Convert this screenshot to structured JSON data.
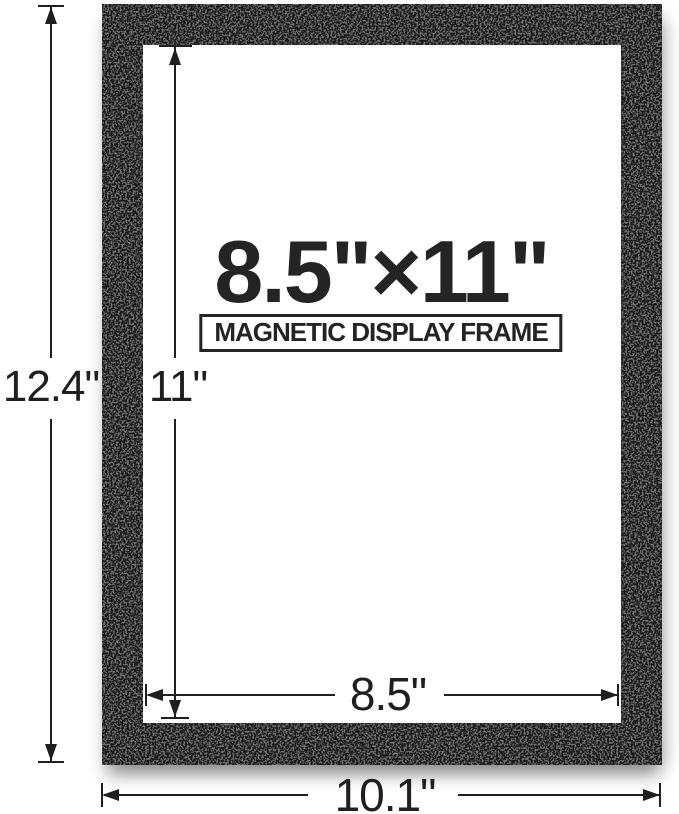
{
  "product_diagram": {
    "title": "8.5\"×11\"",
    "badge": "MAGNETIC DISPLAY FRAME",
    "dimensions": {
      "outer_height": "12.4\"",
      "opening_height": "11\"",
      "opening_width": "8.5\"",
      "outer_width": "10.1\""
    },
    "colors": {
      "frame": "#161616",
      "ink": "#1f1f1f",
      "background": "#ffffff"
    }
  }
}
